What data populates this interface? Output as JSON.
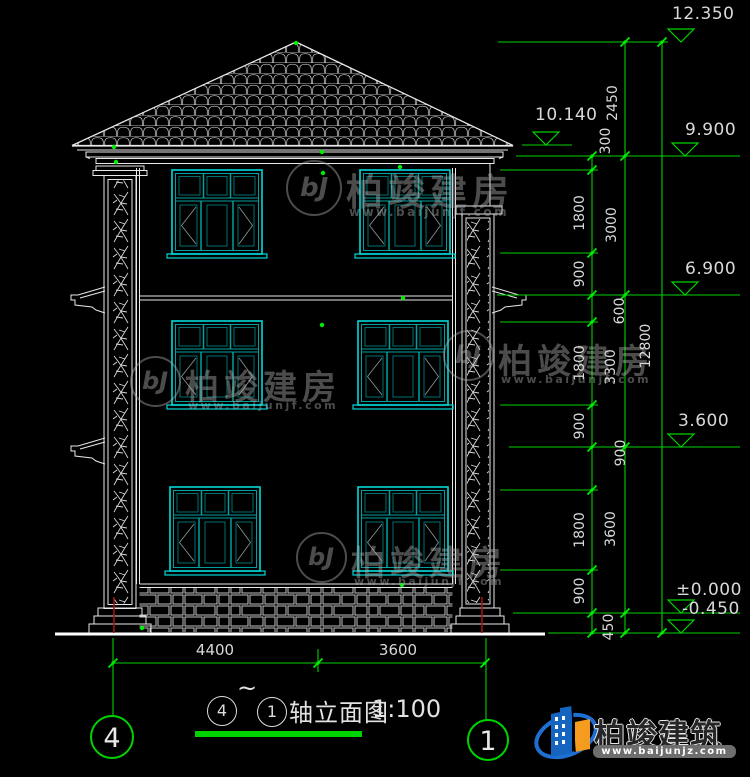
{
  "elev": [
    "12.350",
    "10.140",
    "9.900",
    "6.900",
    "3.600",
    "±0.000",
    "-0.450"
  ],
  "dims": {
    "inner": [
      "300",
      "1800",
      "900",
      "600",
      "1800",
      "900",
      "900",
      "1800",
      "900",
      "450"
    ],
    "middle": [
      "2450",
      "3000",
      "3300",
      "3600"
    ],
    "overall": "12800",
    "bottom": [
      "4400",
      "3600"
    ]
  },
  "grid": {
    "left_bubble": "4",
    "right_bubble": "1"
  },
  "title_block": {
    "circle_a": "4",
    "tilde": "~",
    "circle_b": "1",
    "name": "轴立面图",
    "scale": "1:100"
  },
  "watermark": {
    "monogram": "bJ",
    "name": "柏竣建房",
    "url": "www.baijunjf.com"
  },
  "brand": {
    "name": "柏竣建筑",
    "url": "www.baijunjz.com"
  },
  "colors": {
    "background": "#000000",
    "drawing_line": "#e8e8e8",
    "dimension_green": "#00d400",
    "window_cyan": "#00d9d9",
    "window_teal": "#00a0a0",
    "axis_red": "#aa1111",
    "brand_blue": "#1565c0",
    "brand_orange": "#f59b20"
  }
}
